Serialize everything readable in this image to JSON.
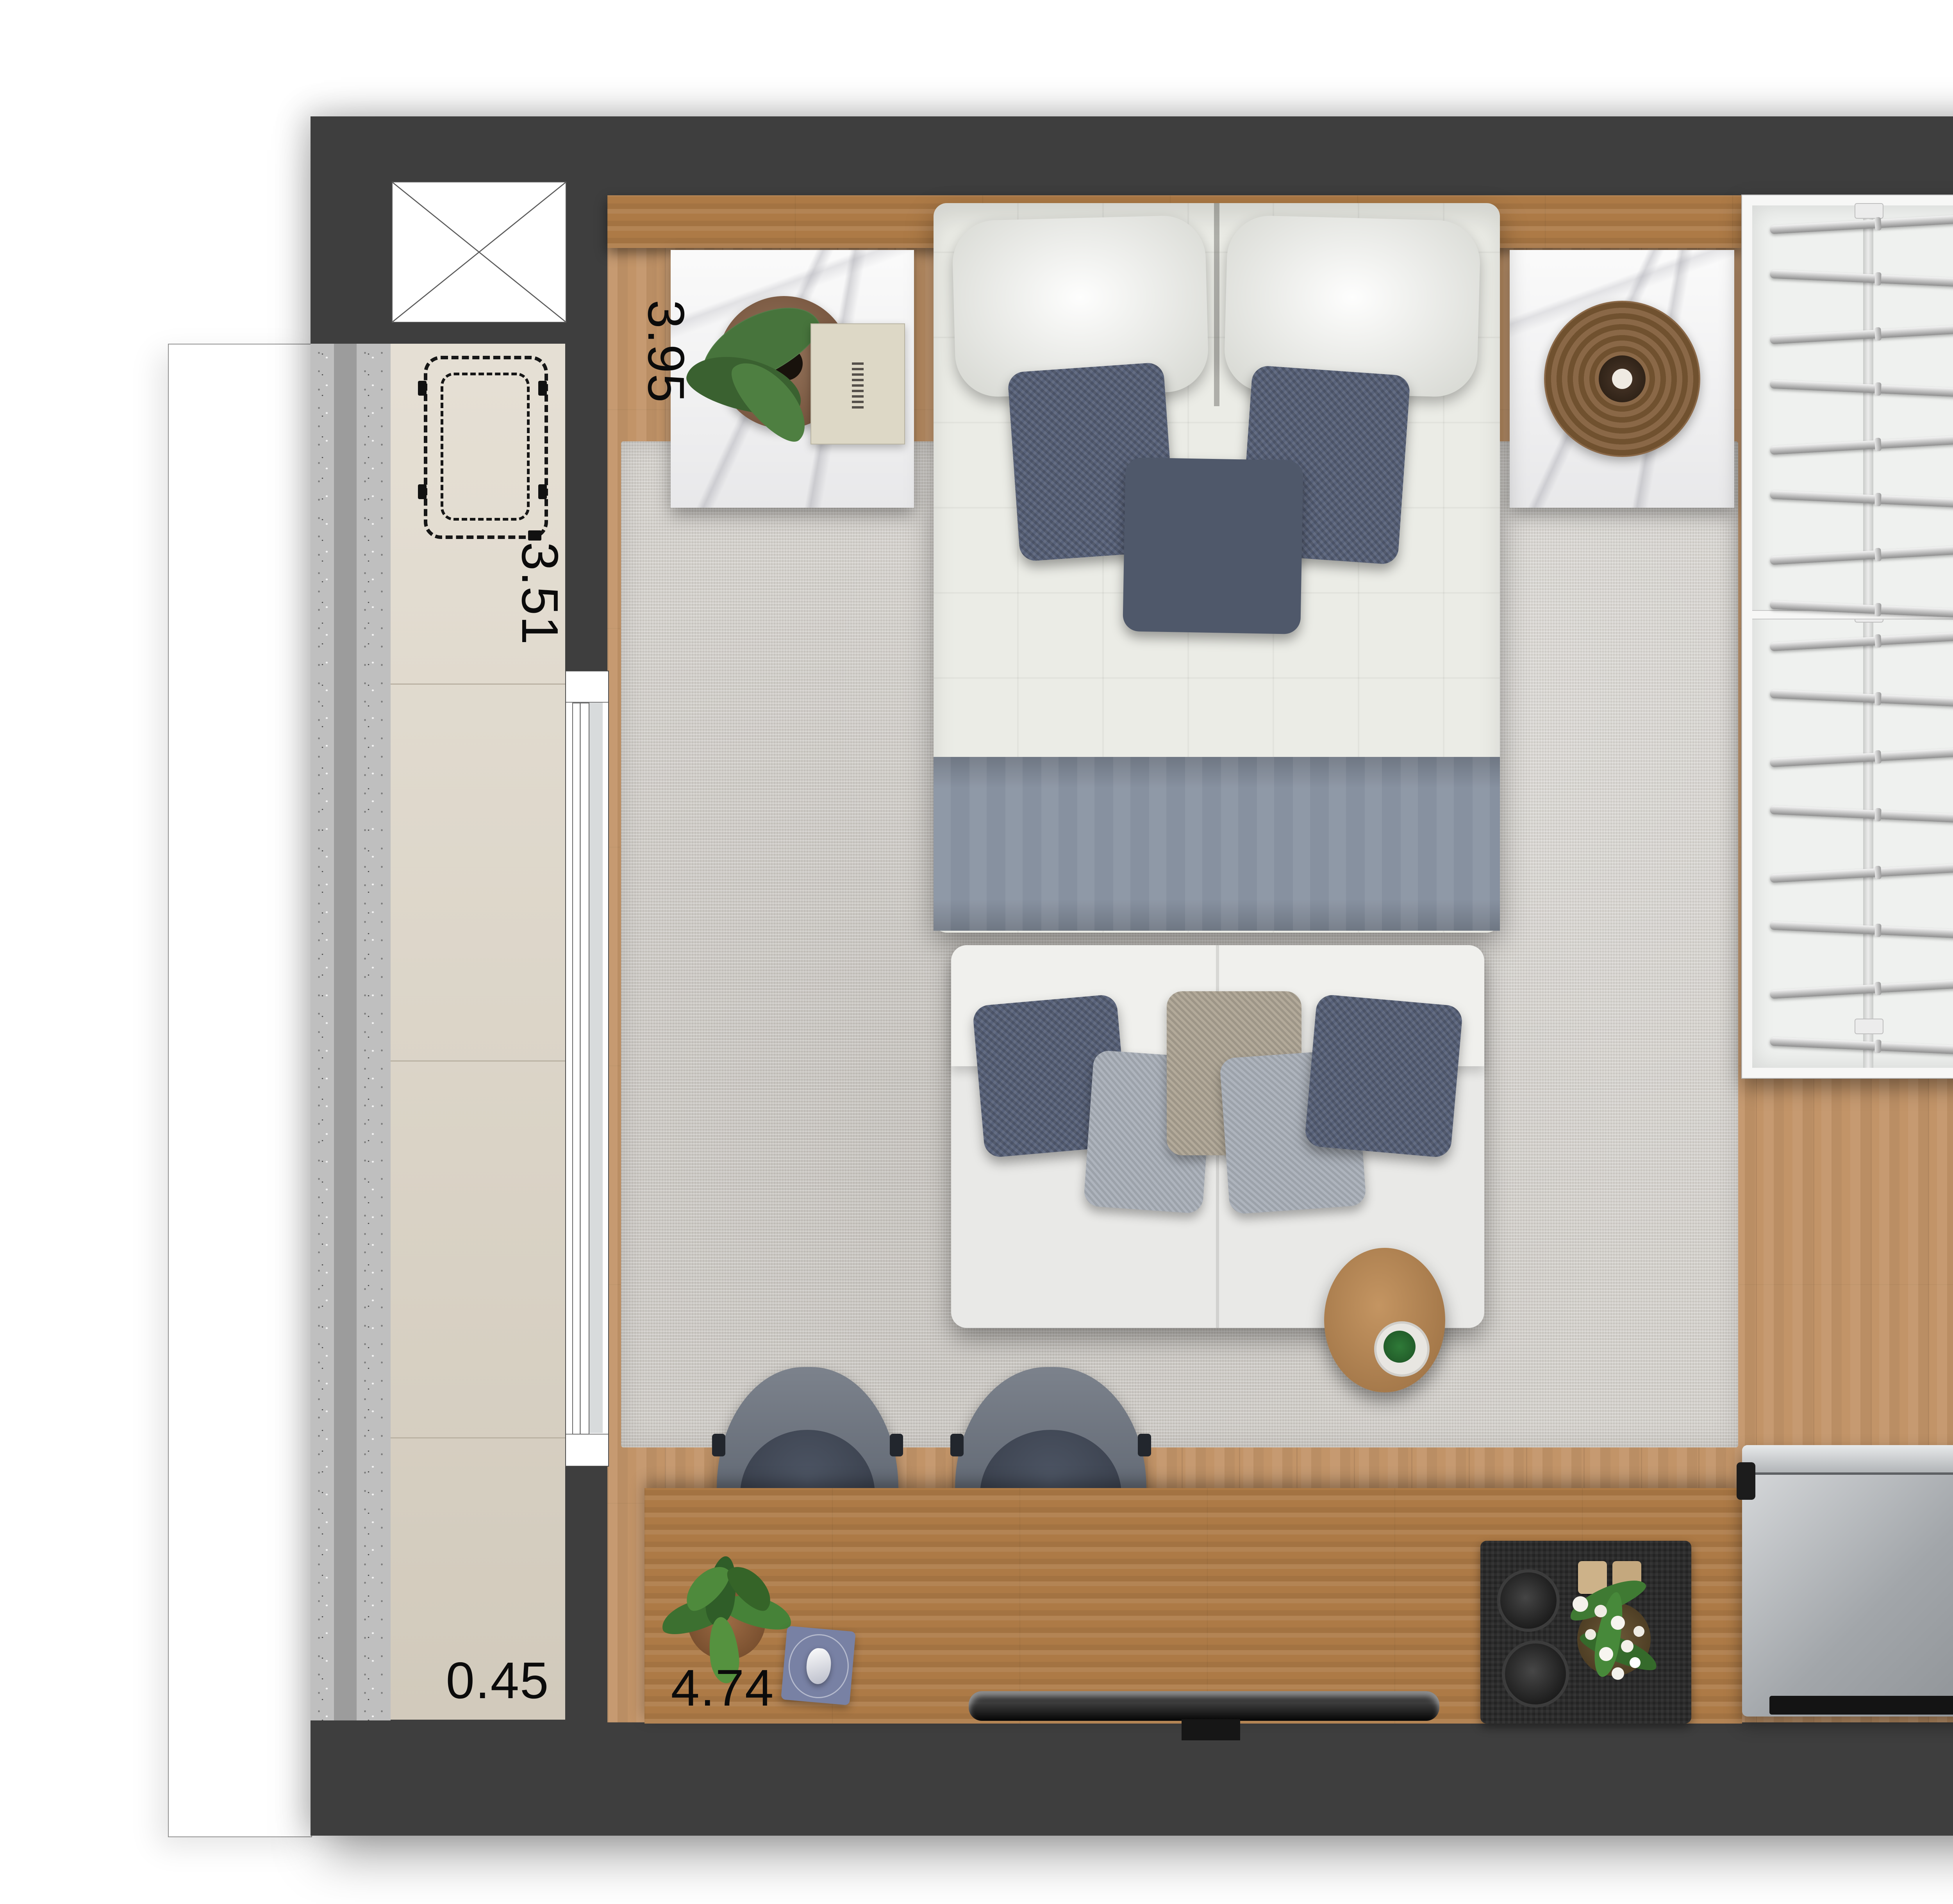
{
  "document": {
    "type": "apartment-floor-plan",
    "view": "top-down-rendered"
  },
  "dimension_labels": [
    {
      "id": "dim-top-left",
      "text": "3.95",
      "orientation": "vertical"
    },
    {
      "id": "dim-bathroom-top",
      "text": "2.12",
      "orientation": "vertical"
    },
    {
      "id": "dim-balcony-side",
      "text": "3.51",
      "orientation": "vertical"
    },
    {
      "id": "dim-bathroom-low",
      "text": "1.42",
      "orientation": "horizontal"
    },
    {
      "id": "dim-balcony-width",
      "text": "0.45",
      "orientation": "horizontal"
    },
    {
      "id": "dim-counter-run",
      "text": "4.74",
      "orientation": "horizontal"
    }
  ],
  "colors": {
    "wall": "#3e3e3e",
    "wood_floor": "#c29468",
    "desk_wood": "#ad7a46",
    "balcony_tile": "#ddd5c6",
    "bathroom_tile": "#e7e0d2",
    "granite_counter": "#e4e4e2",
    "rug": "#d1cec9",
    "pillow_navy": "#58627a",
    "blanket_blue_gray": "#8791a0",
    "appliance_steel": "#c2c5c8"
  },
  "fixtures": [
    "double-bed",
    "white-pillows",
    "navy-throw-pillows",
    "nightstand-marble-left",
    "nightstand-marble-right",
    "plant-monstera",
    "decor-book",
    "rattan-tray",
    "wardrobe-hangers",
    "shower-head",
    "toilet",
    "vanity-sink",
    "sofa-two-seat",
    "round-side-table",
    "desk-chairs",
    "desk-counter",
    "desk-plant",
    "blue-plate",
    "tv-monitor",
    "serving-mat-with-flowers",
    "fridge",
    "kitchen-sink",
    "two-burner-cooktop",
    "ac-unit-dashed",
    "shaft-x-boxes",
    "sliding-door-balcony",
    "window-right-wall",
    "door-opening-bathroom"
  ]
}
